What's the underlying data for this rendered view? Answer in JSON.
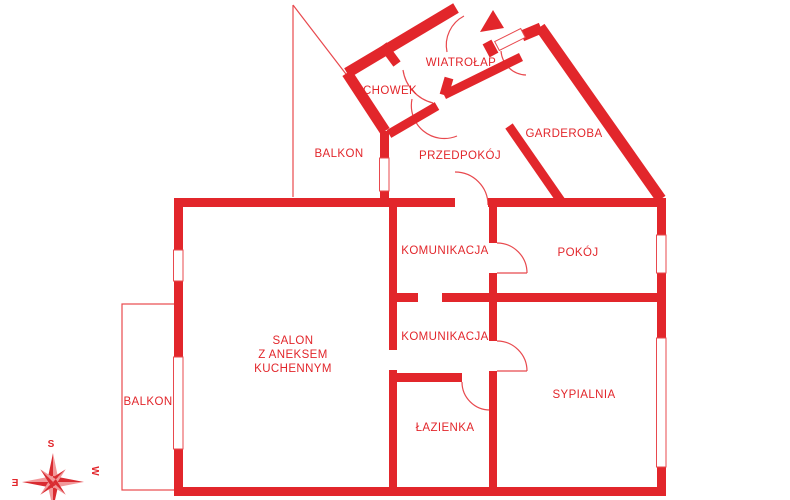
{
  "rooms": {
    "wiatrolap": {
      "label": "WIATROŁAP"
    },
    "schowek": {
      "label": "SCHOWEK"
    },
    "balkon_top": {
      "label": "BALKON"
    },
    "przedpokoj": {
      "label": "PRZEDPOKÓJ"
    },
    "garderoba": {
      "label": "GARDEROBA"
    },
    "komunikacja_upper": {
      "label": "KOMUNIKACJA"
    },
    "pokoj": {
      "label": "POKÓJ"
    },
    "salon": {
      "lines": [
        "SALON",
        "Z ANEKSEM",
        "KUCHENNYM"
      ]
    },
    "komunikacja_lower": {
      "label": "KOMUNIKACJA"
    },
    "lazienka": {
      "label": "ŁAZIENKA"
    },
    "sypialnia": {
      "label": "SYPIALNIA"
    },
    "balkon_left": {
      "label": "BALKON"
    }
  },
  "compass": {
    "south": "S",
    "east": "E",
    "west": "W"
  },
  "colors": {
    "wall": "#e2262b",
    "thin": "#e8494e",
    "compass_dark": "#d92b31",
    "compass_light": "#f2989a"
  }
}
